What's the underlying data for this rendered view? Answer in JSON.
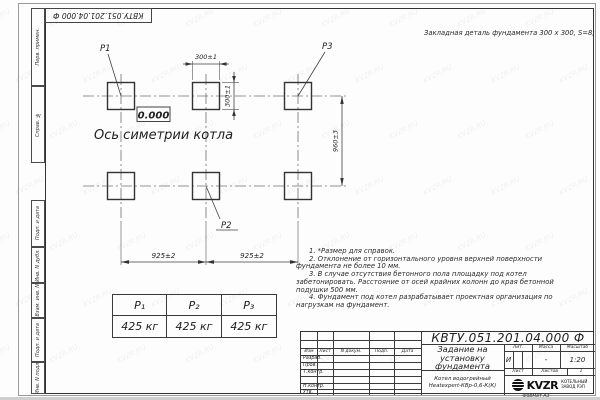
{
  "stamp_top": "КВТУ.051.201.04.000  Ф",
  "watermark": "KVZR.RU",
  "margin_labels": [
    "Перв. примен.",
    "Справ. №",
    "Подп. и дата",
    "Инв. N дубл.",
    "Взам. инв. N",
    "Подп. и дата",
    "Инв. N подл."
  ],
  "top_note": "Закладная деталь фундамента  300 x 300,  S=8;",
  "drawing": {
    "labels": {
      "p1": "P1",
      "p2": "P2",
      "p3": "P3"
    },
    "elevation": "0.000",
    "axis_caption": "Ось симетрии котла",
    "dims": {
      "w300": "300±1",
      "h300": "300±1",
      "v960": "960±3",
      "h925a": "925±2",
      "h925b": "925±2"
    }
  },
  "load_table": {
    "headers": [
      "P₁",
      "P₂",
      "P₃"
    ],
    "values": [
      "425 кг",
      "425 кг",
      "425 кг"
    ]
  },
  "notes": [
    "1. *Размер для справок.",
    "2. Отклонение от горизонтального уровня верхней поверхности фундамента не более 10 мм.",
    "3. В случае отсутствия бетонного пола площадку под котел забетонировать. Расстояние от осей крайних колонн до края бетонной подушки 500 мм.",
    "4. Фундамент под котел разрабатывает проектная организация по нагрузкам на фундамент."
  ],
  "title_block": {
    "doc_number": "КВТУ.051.201.04.000  Ф",
    "title_lines": [
      "Задание на",
      "установку",
      "фундамента"
    ],
    "product_lines": [
      "Котел водогрейный",
      "Heatexpert-КВр-0,6-К(К)"
    ],
    "header_cols": [
      "Изм",
      "Лист",
      "N докум.",
      "Подп.",
      "Дата"
    ],
    "sig_labels": [
      "Разраб.",
      "Пров.",
      "Т.контр.",
      "Н.контр.",
      "Утв."
    ],
    "lit_label": "Лит.",
    "lit_value": "И",
    "mass_label": "Масса",
    "mass_value": "-",
    "scale_label": "Масштаб",
    "scale_value": "1:20",
    "sheet_label": "Лист",
    "sheets_label": "Листов",
    "sheets_value": "1",
    "logo_text": "KVZR",
    "company_lines": [
      "КОТЕЛЬНЫЙ",
      "ЗАВОД РЭП"
    ],
    "format_label": "Формат А3"
  }
}
